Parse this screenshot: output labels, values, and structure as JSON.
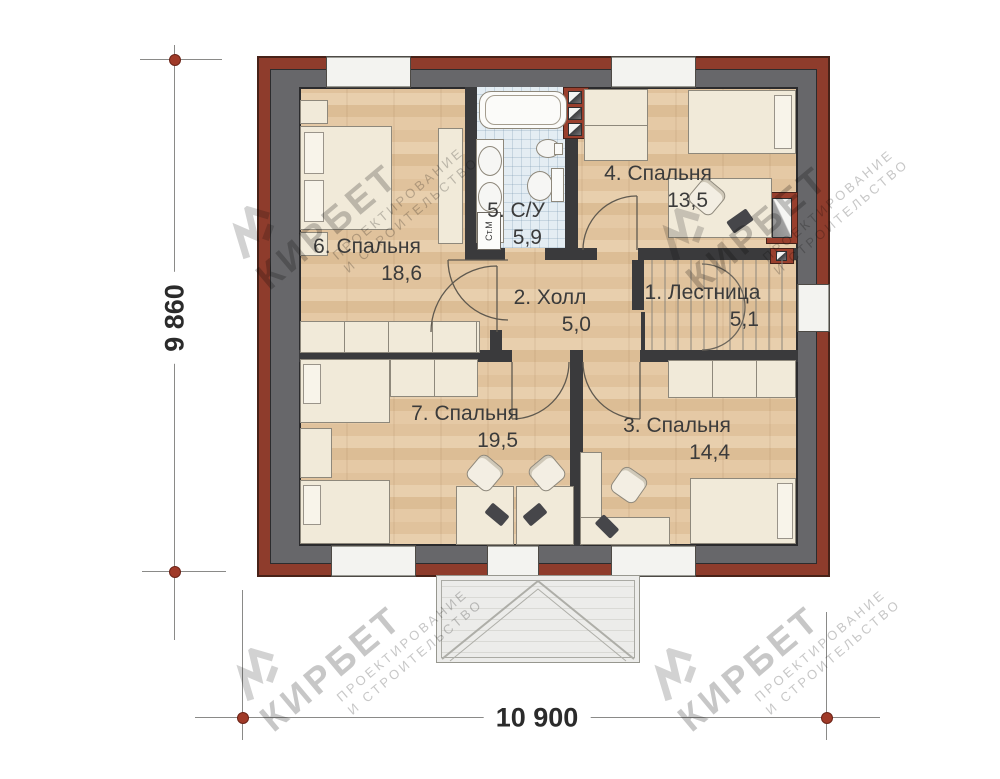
{
  "plan": {
    "rooms": [
      {
        "id": "bedroom-6",
        "label": "6. Спальня",
        "area": "18,6"
      },
      {
        "id": "bathroom-5",
        "label": "5. С/У",
        "area": "5,9"
      },
      {
        "id": "bedroom-4",
        "label": "4. Спальня",
        "area": "13,5"
      },
      {
        "id": "hall-2",
        "label": "2. Холл",
        "area": "5,0"
      },
      {
        "id": "stairs-1",
        "label": "1. Лестница",
        "area": "5,1"
      },
      {
        "id": "bedroom-7",
        "label": "7. Спальня",
        "area": "19,5"
      },
      {
        "id": "bedroom-3",
        "label": "3. Спальня",
        "area": "14,4"
      }
    ],
    "appliances": {
      "washing_machine": "Ст.М"
    },
    "dimensions": {
      "width": "10 900",
      "height": "9 860"
    },
    "colors": {
      "brick_red": "#8e3c2c",
      "wall_gray": "#67676a",
      "interior_wall": "#3a3a3c",
      "floor_wood": "#e3c9a6",
      "tile_blue": "#e4edf3",
      "marker_red": "#a03a28"
    }
  },
  "watermark": {
    "brand": "КИРБЕТ",
    "line1": "ПРОЕКТИРОВАНИЕ",
    "line2": "И СТРОИТЕЛЬСТВО"
  }
}
